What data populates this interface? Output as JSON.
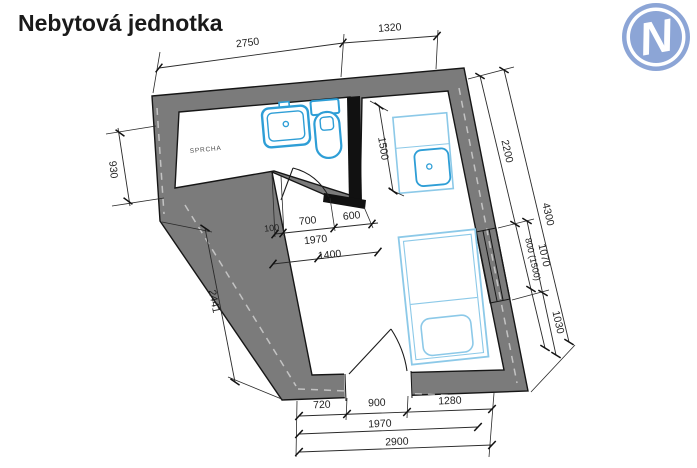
{
  "title": "Nebytová jednotka",
  "logo": {
    "letter": "N",
    "color": "#8CA5D6"
  },
  "plan": {
    "room_label": "SPRCHA",
    "colors": {
      "wall": "#7B7B7B",
      "partition": "#111111",
      "sanitary": "#2E9ED6",
      "furniture": "#8CC9E8",
      "dim_text": "#1F1F1F"
    },
    "dims": {
      "top_a": "2750",
      "top_b": "1320",
      "left_a": "930",
      "left_b": "2441",
      "right_a": "2200",
      "right_b": "800 (1500)",
      "right_c": "1070",
      "right_d": "1030",
      "right_total": "4300",
      "mid_a": "100",
      "mid_b": "700",
      "mid_c": "600",
      "mid_d": "1970",
      "mid_e": "1400",
      "mid_f": "1500",
      "bottom_a": "720",
      "bottom_b": "900",
      "bottom_c": "1280",
      "bottom_d": "1970",
      "bottom_e": "2900"
    }
  }
}
